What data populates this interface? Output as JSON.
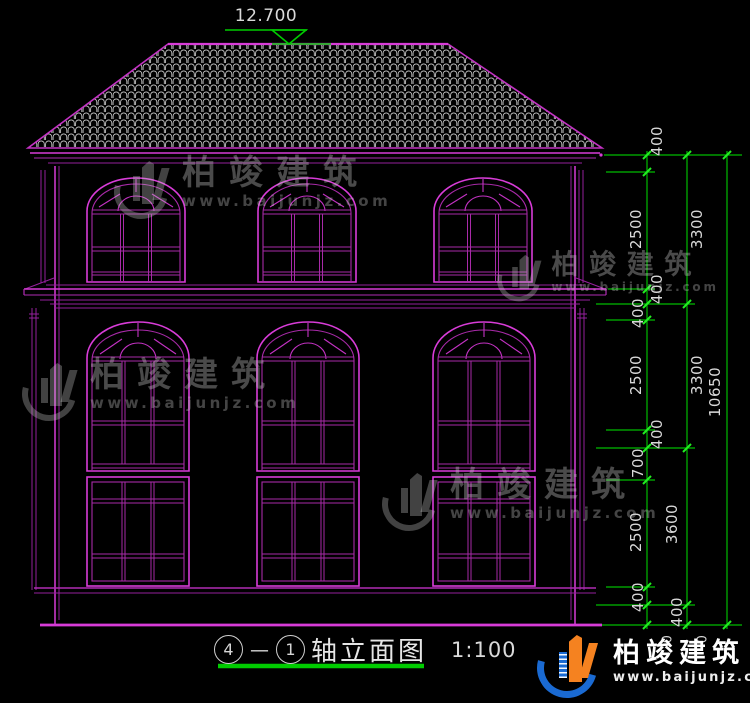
{
  "elevation_marks": {
    "roof_ridge": "12.700",
    "ground_left": "0",
    "ground_right": "0"
  },
  "dimensions": {
    "vertical_labels": [
      "400",
      "2500",
      "3300",
      "400",
      "400",
      "2500",
      "3300",
      "400",
      "700",
      "2500",
      "3600",
      "10650",
      "400",
      "400"
    ],
    "total_height": "10650"
  },
  "title_block": {
    "axis_start": "4",
    "dash": "—",
    "axis_end": "1",
    "title": "轴立面图",
    "scale": "1:100"
  },
  "watermark": {
    "brand": "柏竣建筑",
    "url": "www.baijunjz.com"
  },
  "brand_footer": {
    "brand": "柏竣建筑",
    "url": "www.baijunjz.com"
  },
  "colors": {
    "background": "#000000",
    "line_magenta": "#c332c3",
    "line_magenta_bright": "#d83cd8",
    "dimension_green": "#00bb00",
    "tick_green": "#22ee22",
    "text_gray": "#d9d9d9",
    "logo_blue": "#1a6ad2",
    "logo_orange": "#f58220"
  }
}
